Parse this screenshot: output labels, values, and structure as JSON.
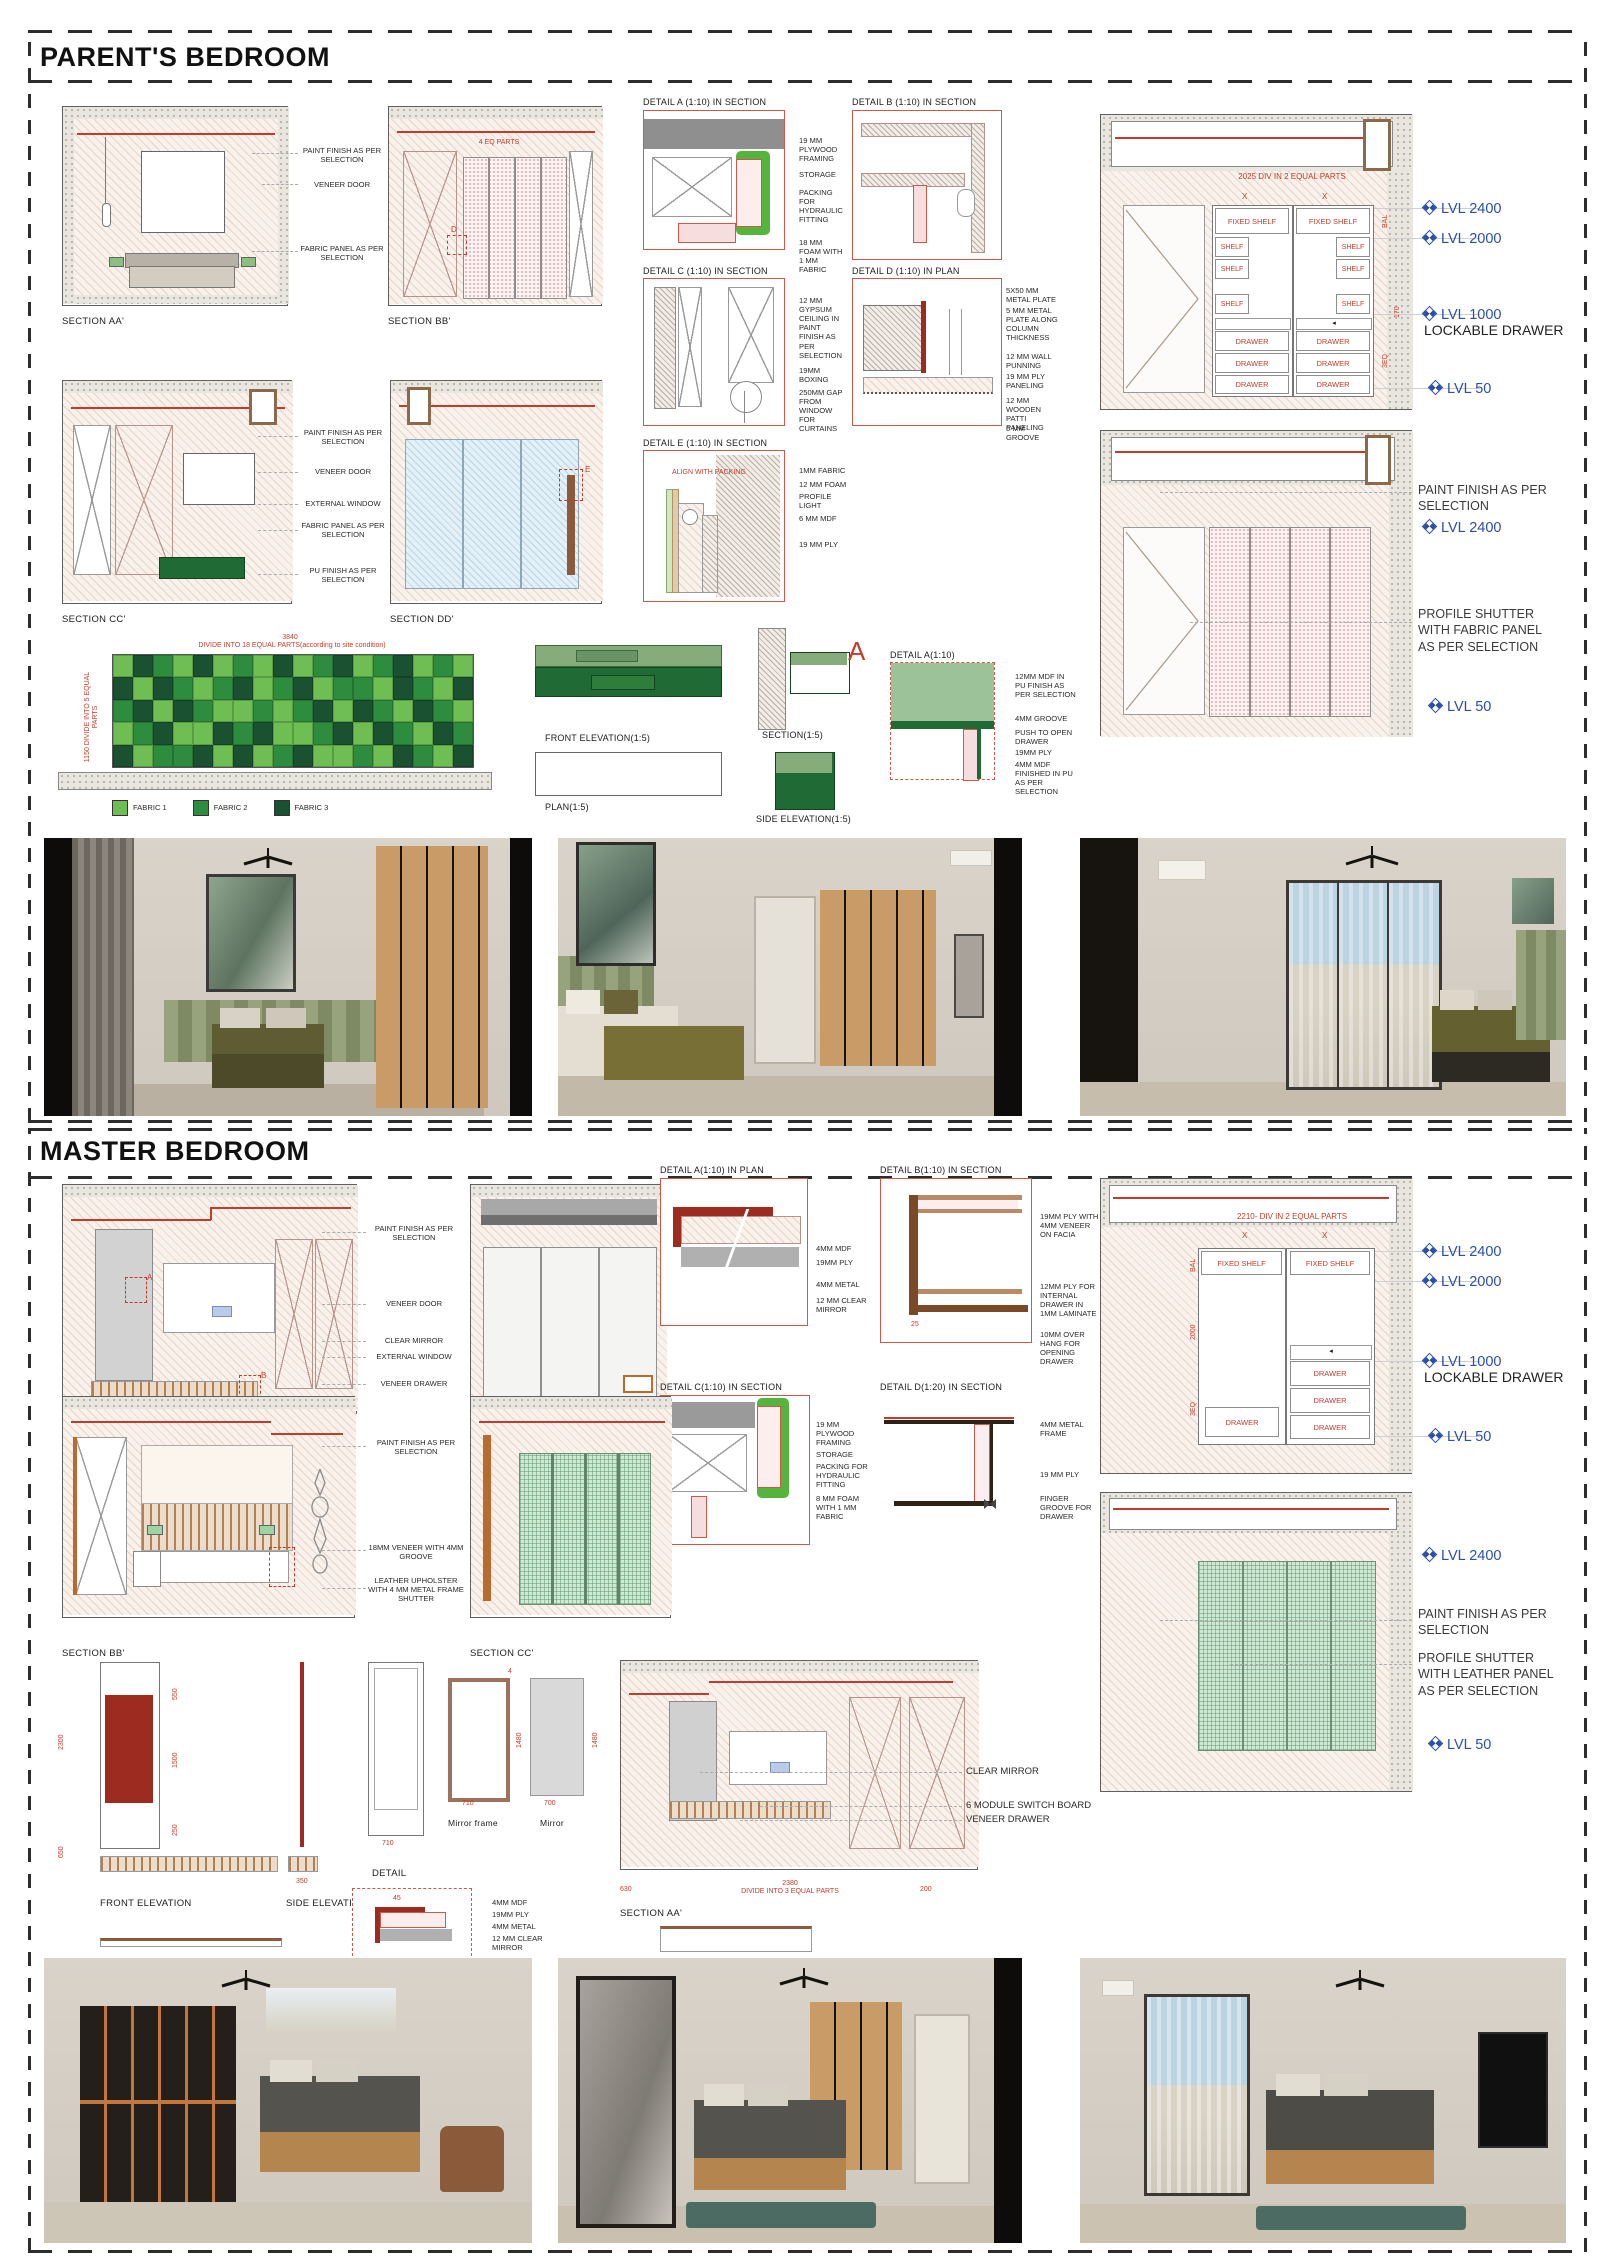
{
  "palette": {
    "red": "#c43b2b",
    "blue": "#2b4fa7",
    "ink": "#1b1b1b",
    "fabric1": "#6fbe53",
    "fabric2": "#2e8c3f",
    "fabric3": "#1a5130",
    "green": "#54b43c",
    "mint": "#cfe9d4",
    "cl": "#86ac7c",
    "cd": "#206b35",
    "csage": "#9cc29a",
    "maroon": "#9e2b1f",
    "brown": "#a06a43",
    "wood": "#c99c67"
  },
  "parent": {
    "title": "PARENT'S BEDROOM",
    "row1": {
      "aa_label": "SECTION AA'",
      "bb_label": "SECTION BB'",
      "bb_dim": "4 EQ PARTS",
      "bb_marker": "D",
      "callouts": [
        "PAINT FINISH AS PER SELECTION",
        "VENEER DOOR",
        "FABRIC PANEL AS PER SELECTION"
      ]
    },
    "row2": {
      "cc_label": "SECTION CC'",
      "dd_label": "SECTION DD'",
      "dd_marker": "E",
      "callouts": [
        "PAINT FINISH AS PER SELECTION",
        "VENEER DOOR",
        "EXTERNAL WINDOW",
        "FABRIC PANEL AS PER SELECTION",
        "PU FINISH AS PER SELECTION"
      ]
    },
    "details": {
      "a_title": "DETAIL A (1:10) IN SECTION",
      "b_title": "DETAIL B (1:10) IN SECTION",
      "c_title": "DETAIL C (1:10) IN SECTION",
      "d_title": "DETAIL D (1:10) IN PLAN",
      "e_title": "DETAIL E (1:10) IN SECTION",
      "ab_callouts": [
        "19 MM PLYWOOD FRAMING",
        "STORAGE",
        "PACKING FOR HYDRAULIC FITTING",
        "18 MM FOAM WITH 1 MM FABRIC"
      ],
      "cd_callouts": [
        "12 MM GYPSUM CEILING IN PAINT FINISH AS PER SELECTION",
        "19MM BOXING",
        "250MM GAP FROM WINDOW FOR CURTAINS"
      ],
      "d_callouts": [
        "5X50 MM METAL PLATE",
        "5 MM METAL PLATE ALONG COLUMN THICKNESS",
        "12 MM WALL PUNNING",
        "19 MM PLY PANELING",
        "12 MM WOODEN PATTI PANELING",
        "5 MM GROOVE"
      ],
      "e_note": "ALIGN WITH PACKING",
      "e_callouts": [
        "1MM FABRIC",
        "12 MM FOAM",
        "PROFILE LIGHT",
        "6 MM MDF",
        "19 MM PLY"
      ]
    },
    "wardrobe": {
      "div_note": "2025 DIV IN 2 EQUAL PARTS",
      "x_left": "X",
      "x_right": "X",
      "fixed_shelf": "FIXED SHELF",
      "shelf": "SHELF",
      "drawer": "DRAWER",
      "side_dims": [
        "BAL",
        "170",
        "3EQ"
      ],
      "levels": [
        "LVL 2400",
        "LVL 2000",
        "LVL 1000",
        "LVL 50"
      ],
      "lockable": "LOCKABLE DRAWER"
    },
    "shutter": {
      "paint": "PAINT FINISH AS PER SELECTION",
      "lvl_top": "LVL 2400",
      "profile": "PROFILE SHUTTER WITH FABRIC PANEL AS PER SELECTION",
      "lvl_bottom": "LVL 50"
    },
    "headboard": {
      "top_dim": "3840",
      "top_note": "DIVIDE INTO 18 EQUAL PARTS(according to site condition)",
      "side_note": "1150 DIVIDE INTO 5 EQUAL PARTS",
      "legend": [
        {
          "label": "FABRIC 1"
        },
        {
          "label": "FABRIC 2"
        },
        {
          "label": "FABRIC 3"
        }
      ],
      "pattern": [
        [
          0,
          2,
          1,
          0,
          2,
          0,
          1,
          0,
          2,
          0,
          1,
          2,
          0,
          1,
          2,
          0,
          1,
          0
        ],
        [
          2,
          0,
          2,
          1,
          0,
          1,
          2,
          0,
          1,
          2,
          0,
          1,
          1,
          0,
          2,
          1,
          0,
          2
        ],
        [
          1,
          2,
          0,
          2,
          1,
          0,
          0,
          1,
          0,
          1,
          2,
          0,
          2,
          1,
          0,
          2,
          1,
          0
        ],
        [
          0,
          1,
          2,
          0,
          0,
          2,
          1,
          2,
          0,
          0,
          1,
          2,
          0,
          2,
          1,
          0,
          2,
          1
        ],
        [
          2,
          0,
          1,
          1,
          2,
          0,
          2,
          0,
          1,
          2,
          0,
          0,
          1,
          0,
          2,
          1,
          0,
          2
        ]
      ]
    },
    "console": {
      "front_label": "FRONT ELEVATION(1:5)",
      "plan_label": "PLAN(1:5)",
      "section_label": "SECTION(1:5)",
      "side_label": "SIDE ELEVATION(1:5)",
      "detail_title": "DETAIL A(1:10)",
      "marker": "A",
      "callouts": [
        "12MM MDF IN PU FINISH AS PER SELECTION",
        "4MM GROOVE",
        "PUSH TO OPEN DRAWER",
        "19MM PLY",
        "4MM MDF FINISHED IN PU AS PER SELECTION"
      ]
    }
  },
  "master": {
    "title": "MASTER BEDROOM",
    "row1": {
      "aa_label": "SECTION AA'",
      "dd_label": "SECTION DD'",
      "markers": [
        "A",
        "B"
      ],
      "callouts": [
        "PAINT FINISH AS PER SELECTION",
        "VENEER DOOR",
        "CLEAR MIRROR",
        "EXTERNAL WINDOW",
        "VENEER DRAWER"
      ]
    },
    "row2": {
      "bb_label": "SECTION BB'",
      "cc_label": "SECTION CC'",
      "callouts": [
        "PAINT FINISH AS PER SELECTION",
        "18MM VENEER WITH 4MM GROOVE",
        "LEATHER UPHOLSTER WITH 4 MM METAL FRAME SHUTTER"
      ]
    },
    "details": {
      "a_title": "DETAIL A(1:10) IN PLAN",
      "b_title": "DETAIL B(1:10) IN SECTION",
      "c_title": "DETAIL C(1:10) IN SECTION",
      "d_title": "DETAIL D(1:20) IN SECTION",
      "a_callouts": [
        "4MM MDF",
        "19MM PLY",
        "4MM METAL",
        "12 MM CLEAR MIRROR"
      ],
      "b_callouts": [
        "19MM PLY WITH 4MM VENEER ON FACIA",
        "12MM PLY FOR INTERNAL DRAWER IN 1MM LAMINATE",
        "10MM OVER HANG FOR OPENING DRAWER"
      ],
      "c_callouts": [
        "19 MM PLYWOOD FRAMING",
        "STORAGE",
        "PACKING FOR HYDRAULIC FITTING",
        "8 MM FOAM WITH 1 MM FABRIC"
      ],
      "d_callouts": [
        "4MM METAL FRAME",
        "19 MM PLY",
        "FINGER GROOVE FOR DRAWER"
      ]
    },
    "wardrobe": {
      "div_note": "2210- DIV IN 2 EQUAL PARTS",
      "x_left": "X",
      "x_right": "X",
      "fixed_shelf": "FIXED SHELF",
      "drawer": "DRAWER",
      "side_dims": [
        "BAL",
        "2000",
        "3EQ"
      ],
      "levels": [
        "LVL 2400",
        "LVL 2000",
        "LVL 1000",
        "LVL 50"
      ],
      "lockable": "LOCKABLE DRAWER"
    },
    "shutter": {
      "lvl_top": "LVL 2400",
      "paint": "PAINT FINISH AS PER SELECTION",
      "profile": "PROFILE SHUTTER WITH LEATHER PANEL AS PER SELECTION",
      "lvl_bottom": "LVL 50"
    },
    "mirror": {
      "front_label": "FRONT ELEVATION",
      "side_label": "SIDE ELEVATION",
      "plan_label": "PLAN",
      "frame_label": "Mirror frame",
      "mirror_label": "Mirror",
      "detail_label": "DETAIL",
      "dims": {
        "overall": "2300",
        "top": "550",
        "mid": "1500",
        "bottom": "250",
        "base": "650",
        "side_w": "350",
        "w1": "710",
        "w2": "710",
        "w3": "700",
        "h2": "1480",
        "t": "4",
        "corner": "45"
      },
      "detail_callouts": [
        "4MM MDF",
        "19MM PLY",
        "4MM METAL",
        "12 MM CLEAR MIRROR"
      ]
    },
    "bottom": {
      "aa_label": "SECTION AA'",
      "callouts": [
        "CLEAR MIRROR",
        "6 MODULE SWITCH BOARD",
        "VENEER DRAWER"
      ],
      "dim": "2380",
      "divide_note": "DIVIDE INTO 3 EQUAL PARTS",
      "left_dim": "630",
      "right_dim": "200"
    }
  }
}
